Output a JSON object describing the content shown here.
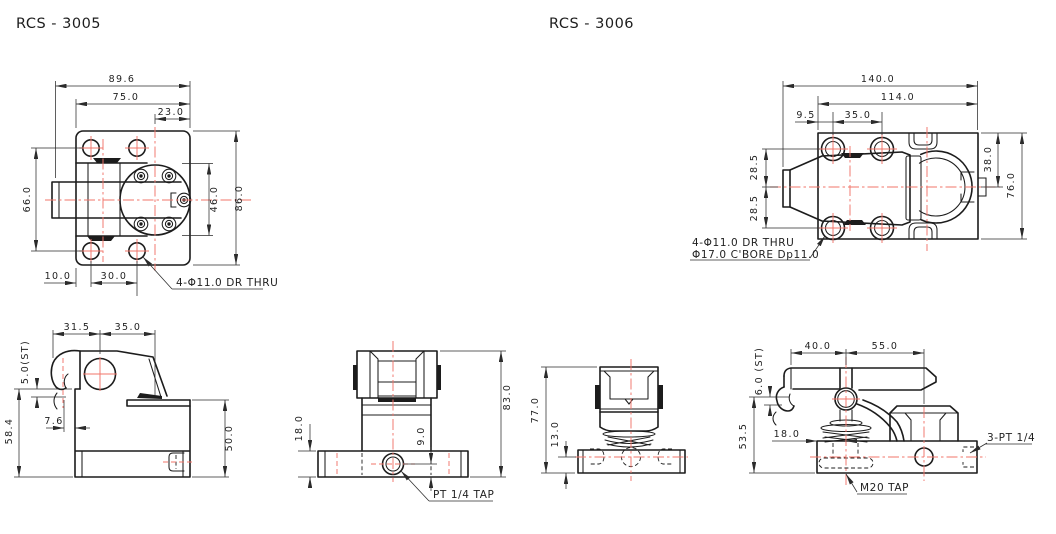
{
  "colors": {
    "line": "#1c1c1c",
    "dimension": "#2b2b2b",
    "centerline": "#f2756a",
    "background": "#ffffff"
  },
  "titles": {
    "left": "RCS - 3005",
    "right": "RCS - 3006"
  },
  "rcs3005": {
    "plan": {
      "dim_total_w": "89.6",
      "dim_plate_w": "75.0",
      "dim_offset": "23.0",
      "dim_hole_span": "66.0",
      "dim_mech_h": "46.0",
      "dim_plate_h": "86.0",
      "dim_edge": "10.0",
      "dim_pitch": "30.0",
      "note_holes": "4-Φ11.0 DR THRU"
    },
    "side": {
      "dim_rear": "31.5",
      "dim_front": "35.0",
      "dim_stroke": "5.0(ST)",
      "dim_total_h": "58.4",
      "dim_lip": "7.6",
      "dim_body_h": "50.0"
    },
    "front": {
      "dim_base_h": "18.0",
      "dim_total_h": "83.0",
      "dim_port_h": "9.0",
      "note_port": "PT 1/4 TAP"
    }
  },
  "rcs3006": {
    "plan": {
      "dim_total_l": "140.0",
      "dim_plate_l": "114.0",
      "dim_edge": "9.5",
      "dim_pitch": "35.0",
      "dim_half_top": "28.5",
      "dim_half_bot": "28.5",
      "dim_half_w": "38.0",
      "dim_plate_w": "76.0",
      "note_holes_1": "4-Φ11.0 DR THRU",
      "note_holes_2": "Φ17.0 C'BORE Dp11.0"
    },
    "front": {
      "dim_total_h": "77.0",
      "dim_port_h": "13.0"
    },
    "side": {
      "dim_rear": "40.0",
      "dim_front": "55.0",
      "dim_stroke": "6.0 (ST)",
      "dim_arm_h": "53.5",
      "dim_tap_off": "18.0",
      "note_ports": "3-PT 1/4",
      "note_tap": "M20 TAP"
    }
  }
}
